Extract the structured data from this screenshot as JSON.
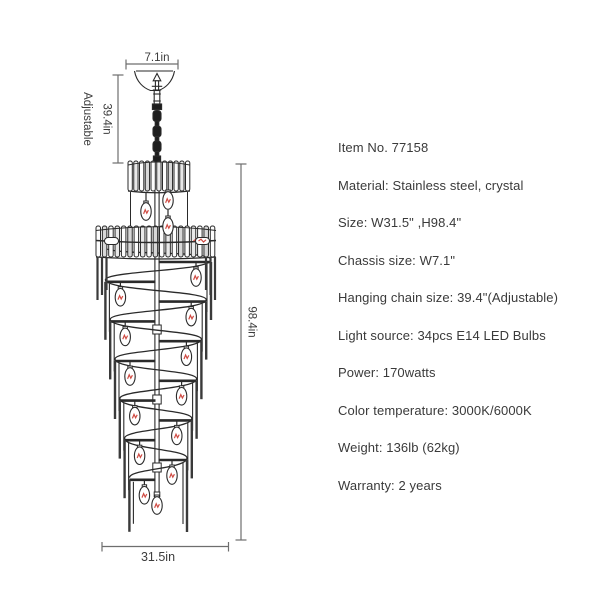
{
  "page": {
    "background": "#ffffff"
  },
  "diagram": {
    "dimensions": {
      "chassis_width": "7.1in",
      "chain_length": "39.4in",
      "chain_note": "Adjustable",
      "total_height": "98.4in",
      "body_width": "31.5in"
    },
    "colors": {
      "line": "#2a2a2a",
      "dimension_line": "#6e6e6e",
      "label_text": "#3c3c3c",
      "bulb_filament": "#cf4a42",
      "chain_fill": "#1d1d1d"
    }
  },
  "specs": {
    "text_color": "#3a3a3a",
    "items": [
      "Item No. 77158",
      "Material: Stainless steel, crystal",
      "Size: W31.5\" ,H98.4\"",
      "Chassis size: W7.1\"",
      "Hanging chain size: 39.4\"(Adjustable)",
      "Light source: 34pcs E14 LED Bulbs",
      "Power: 170watts",
      "Color temperature: 3000K/6000K",
      "Weight: 136lb (62kg)",
      "Warranty: 2 years"
    ]
  }
}
